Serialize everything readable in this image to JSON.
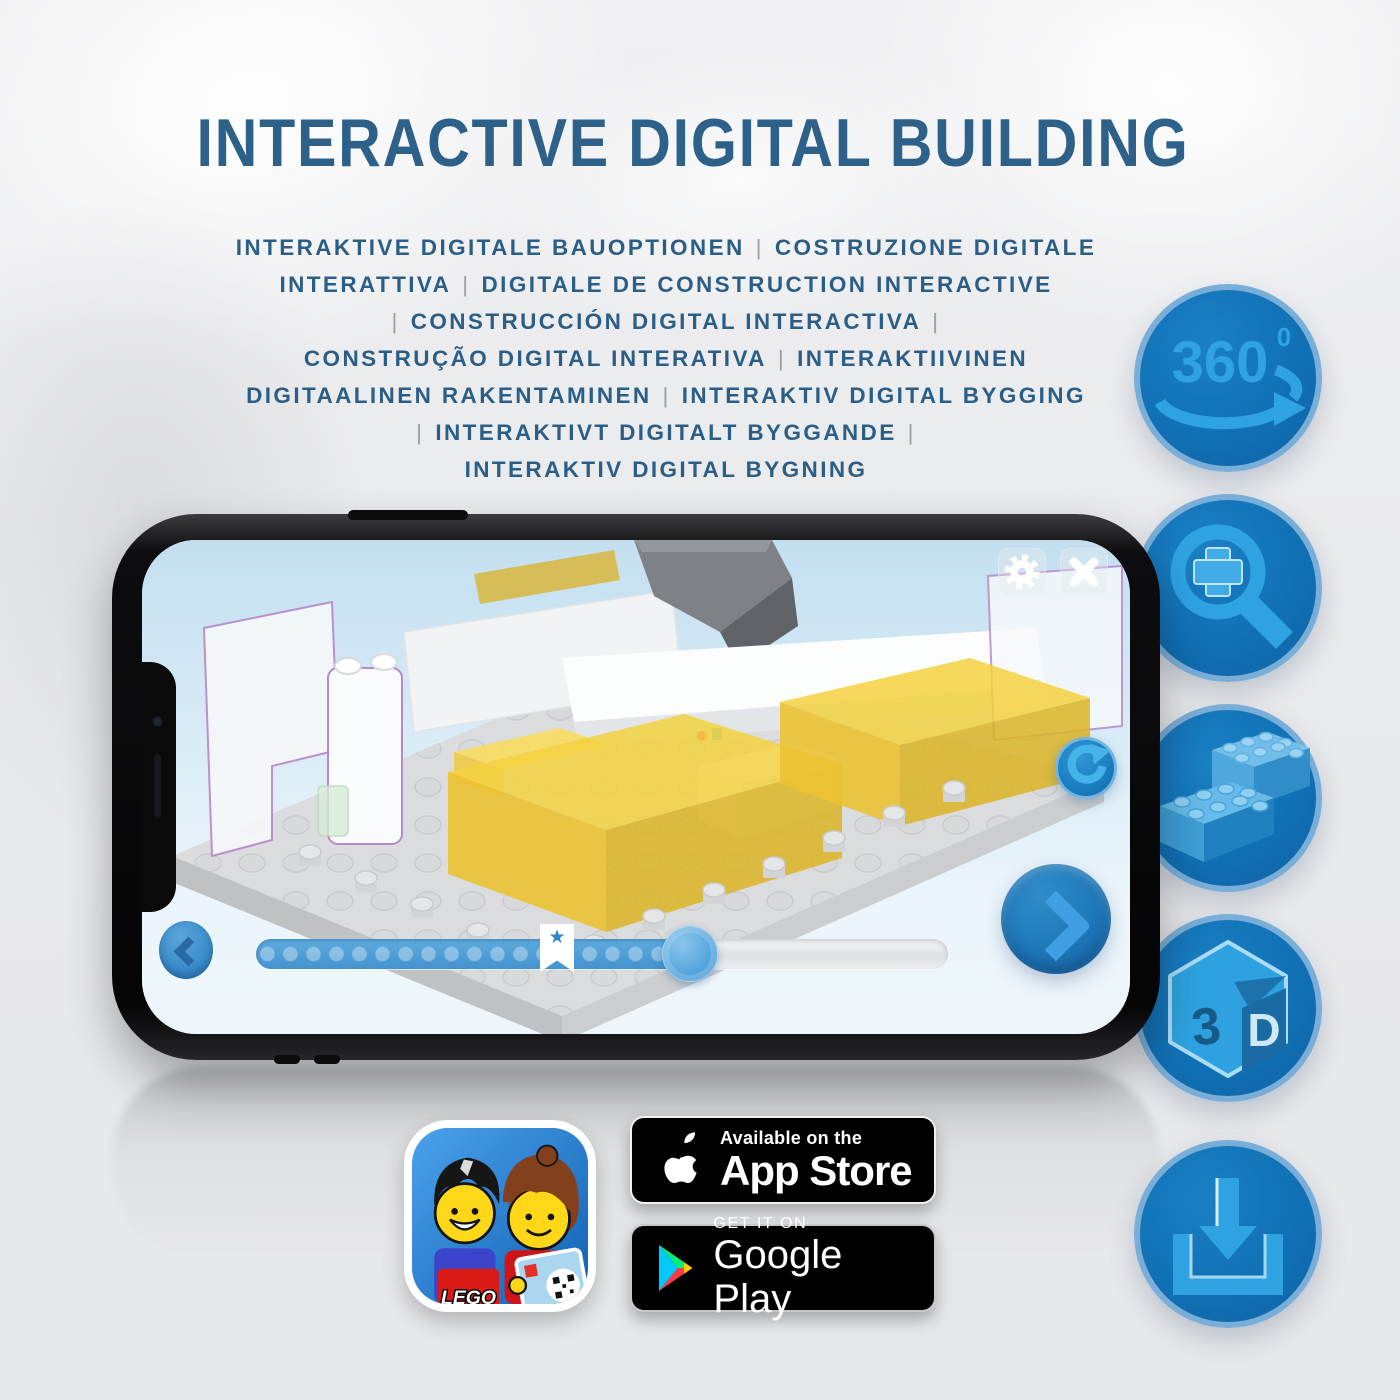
{
  "title": "INTERACTIVE DIGITAL BUILDING",
  "separator_char": "|",
  "subtitle_lines": [
    "INTERAKTIVE DIGITALE BAUOPTIONEN | COSTRUZIONE DIGITALE",
    "INTERATTIVA | DIGITALE DE CONSTRUCTION INTERACTIVE",
    "| CONSTRUCCIÓN DIGITAL INTERACTIVA |",
    "CONSTRUÇÃO DIGITAL INTERATIVA | INTERAKTIIVINEN",
    "DIGITAALINEN RAKENTAMINEN | INTERAKTIV DIGITAL BYGGING",
    "| INTERAKTIVT DIGITALT BYGGANDE |",
    "INTERAKTIV DIGITAL BYGNING"
  ],
  "side_icons": [
    {
      "id": "360-view",
      "label": "360",
      "label_sup": "0",
      "icon": "360-rotation-arrow-icon"
    },
    {
      "id": "zoom",
      "icon": "magnifier-plus-icon"
    },
    {
      "id": "digital-bricks",
      "icon": "lego-bricks-icon"
    },
    {
      "id": "3d-view",
      "icon": "3d-cube-icon",
      "cube_left": "3",
      "cube_right": "D"
    },
    {
      "id": "download",
      "icon": "download-tray-icon"
    }
  ],
  "phone": {
    "screen_ui": {
      "settings_icon": "gear-icon",
      "close_icon": "close-x-icon",
      "rotate_icon": "refresh-rotate-icon",
      "prev_icon": "chevron-left-icon",
      "next_icon": "chevron-right-icon",
      "slider": {
        "progress_percent": 62,
        "step_dots": 19,
        "marker_icon": "star-bookmark-flag",
        "star_char": "★"
      }
    }
  },
  "app_icon": {
    "label": "lego-building-instructions-app",
    "logo_text": "LEGO"
  },
  "badges": {
    "app_store": {
      "line1": "Available on the",
      "line2": "App Store"
    },
    "google_play": {
      "line1": "GET IT ON",
      "line2": "Google Play"
    }
  },
  "colors": {
    "heading_blue": "#2d6189",
    "feature_circle_blue": "#1171b5",
    "feature_icon_blue": "#2fa2e2",
    "screen_sky_blue": "#cfe6f4",
    "slider_fill_blue": "#4f9fd8",
    "screen_button_blue": "#2f8ccc",
    "brick_yellow": "#f3d140",
    "badge_black": "#000000"
  }
}
